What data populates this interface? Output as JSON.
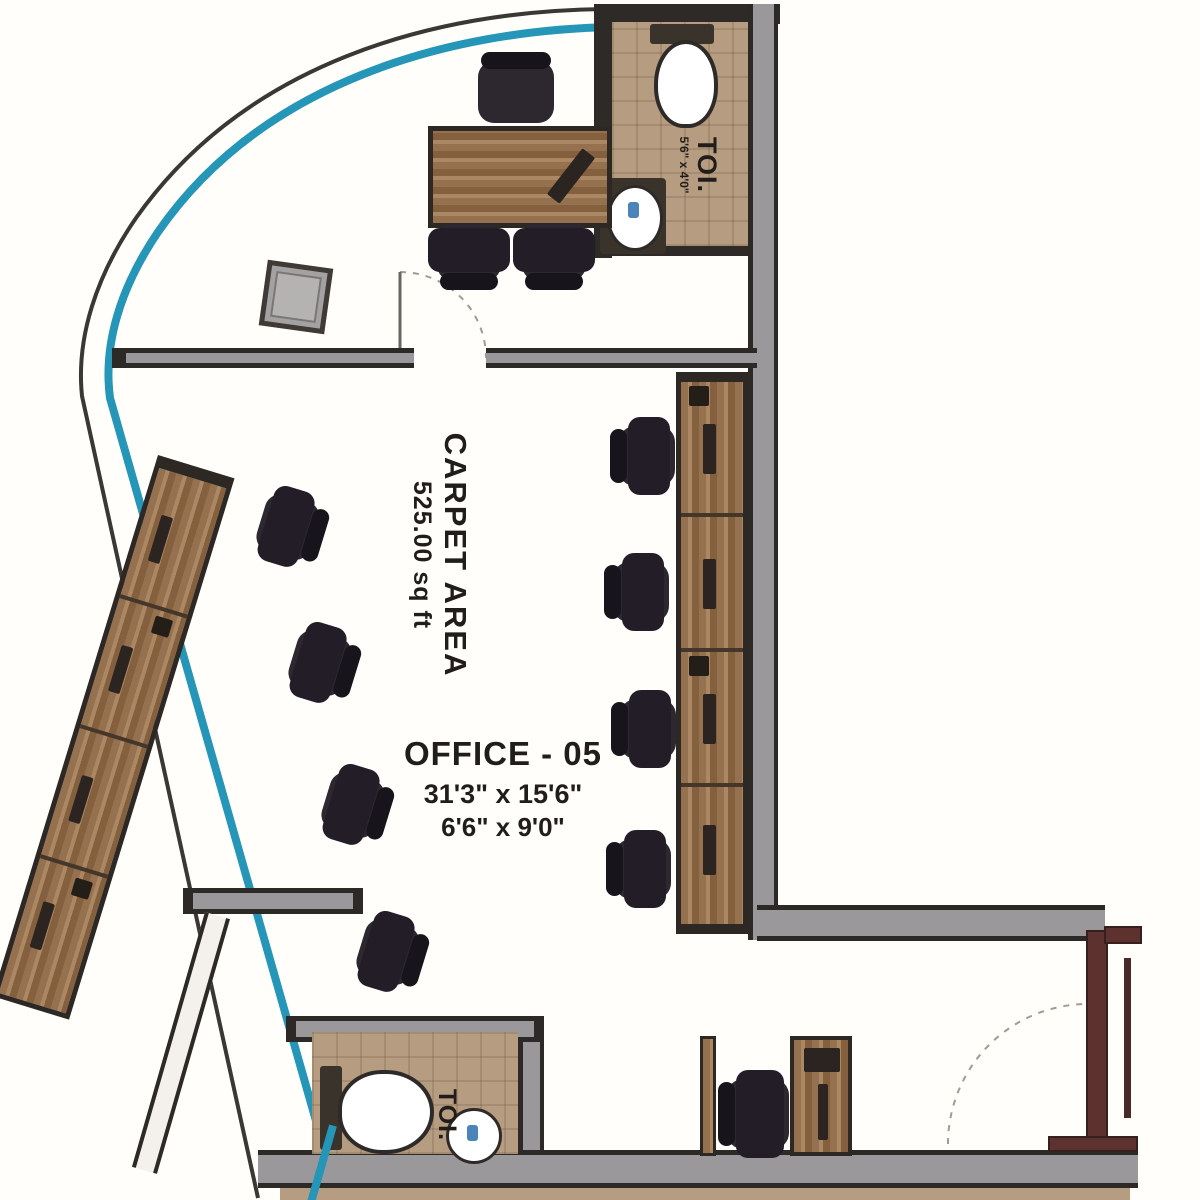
{
  "plan": {
    "labels": {
      "carpet_area_label": "CARPET AREA",
      "carpet_area_value": "525.00 sq ft",
      "room_name": "OFFICE - 05",
      "room_dim1": "31'3\" x 15'6\"",
      "room_dim2": "6'6\" x 9'0\"",
      "toilet_top_label": "TOI.",
      "toilet_top_dims": "5'6\" x 4'0\"",
      "toilet_bottom_label": "TOI."
    },
    "colors": {
      "glass": "#2596b8",
      "wall_dark": "#2e2a27",
      "wall_gray": "#9a989b",
      "wall_maroon": "#5d322e",
      "wood": "#96714f",
      "chair": "#2d2830",
      "tile_floor": "#b69c80",
      "text": "#211d1a"
    }
  }
}
